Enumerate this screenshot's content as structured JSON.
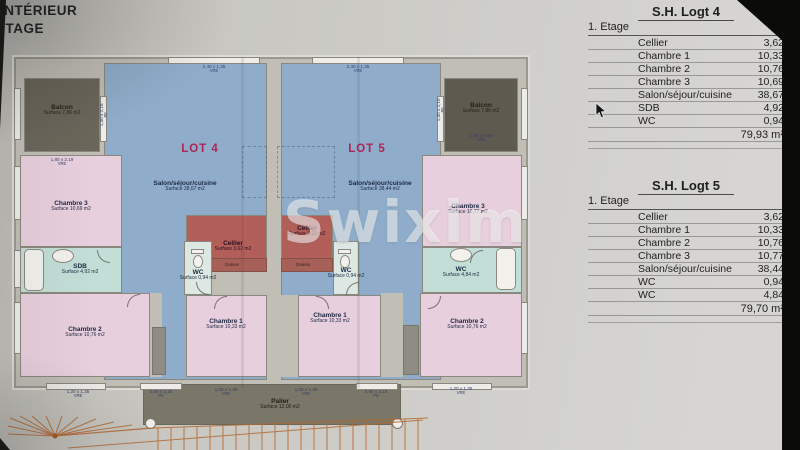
{
  "photo": {
    "header_line1": "INTÉRIEUR",
    "header_line2": "ÉTAGE",
    "watermark": "Swixim"
  },
  "plan": {
    "lot4_label": "LOT 4",
    "lot5_label": "LOT 5",
    "gaines_label": "Gaines",
    "rooms": {
      "balcon4": {
        "name": "Balcon",
        "surface": "Surface 7,86 m2"
      },
      "chambre3_4": {
        "name": "Chambre 3",
        "surface": "Surface 10,69 m2"
      },
      "sdb4": {
        "name": "SDB",
        "surface": "Surface 4,92 m2"
      },
      "chambre2_4": {
        "name": "Chambre 2",
        "surface": "Surface 10,76 m2"
      },
      "salon4": {
        "name": "Salon/séjour/cuisine",
        "surface": "Surface 38,67 m2"
      },
      "cellier4": {
        "name": "Cellier",
        "surface": "Surface 3,62 m2"
      },
      "wc4": {
        "name": "WC",
        "surface": "Surface 0,94 m2"
      },
      "chambre1_4": {
        "name": "Chambre 1",
        "surface": "Surface 10,33 m2"
      },
      "salon5": {
        "name": "Salon/séjour/cuisine",
        "surface": "Surface 38,44 m2"
      },
      "cellier5": {
        "name": "Cellier",
        "surface": "Surface 3,62 m2"
      },
      "wc5": {
        "name": "WC",
        "surface": "Surface 0,94 m2"
      },
      "chambre1_5": {
        "name": "Chambre 1",
        "surface": "Surface 10,33 m2"
      },
      "chambre3_5": {
        "name": "Chambre 3",
        "surface": "Surface 10,77 m2"
      },
      "sdb5": {
        "name": "WC",
        "surface": "Surface 4,84 m2"
      },
      "chambre2_5": {
        "name": "Chambre 2",
        "surface": "Surface 10,76 m2"
      },
      "balcon5": {
        "name": "Balcon",
        "surface": "Surface 7,86 m2"
      },
      "palier": {
        "name": "Palier",
        "surface": "Surface 12,00 m2"
      }
    },
    "dims": [
      {
        "size": "2,40 x 1,35",
        "type": "VRE"
      },
      {
        "size": "2,40 x 1,35",
        "type": "VRE"
      },
      {
        "size": "1,80 x 2,19",
        "type": "VRE"
      },
      {
        "size": "1,40 x 2,15",
        "type": "PF"
      },
      {
        "size": "1,40 x 2,15",
        "type": "PF"
      },
      {
        "size": "1,00 x 0,95",
        "type": "VRE"
      },
      {
        "size": "1,20 x 1,35",
        "type": "VRE"
      },
      {
        "size": "0,90 x 2,15",
        "type": "PE"
      },
      {
        "size": "1,20 x 1,35",
        "type": "VRE"
      },
      {
        "size": "1,20 x 1,35",
        "type": "VRE"
      },
      {
        "size": "0,90 x 2,15",
        "type": "PE"
      },
      {
        "size": "1,20 x 1,35",
        "type": "VRE"
      }
    ]
  },
  "tables": [
    {
      "title": "S.H. Logt 4",
      "floor": "1. Etage",
      "rows": [
        [
          "Cellier",
          "3,62"
        ],
        [
          "Chambre 1",
          "10,33"
        ],
        [
          "Chambre 2",
          "10,76"
        ],
        [
          "Chambre 3",
          "10,69"
        ],
        [
          "Salon/séjour/cuisine",
          "38,67"
        ],
        [
          "SDB",
          "4,92"
        ],
        [
          "WC",
          "0,94"
        ]
      ],
      "total": "79,93 m²"
    },
    {
      "title": "S.H. Logt 5",
      "floor": "1. Etage",
      "rows": [
        [
          "Cellier",
          "3,62"
        ],
        [
          "Chambre 1",
          "10,33"
        ],
        [
          "Chambre 2",
          "10,76"
        ],
        [
          "Chambre 3",
          "10,77"
        ],
        [
          "Salon/séjour/cuisine",
          "38,44"
        ],
        [
          "WC",
          "0,94"
        ],
        [
          "WC",
          "4,84"
        ]
      ],
      "total": "79,70 m²"
    }
  ]
}
